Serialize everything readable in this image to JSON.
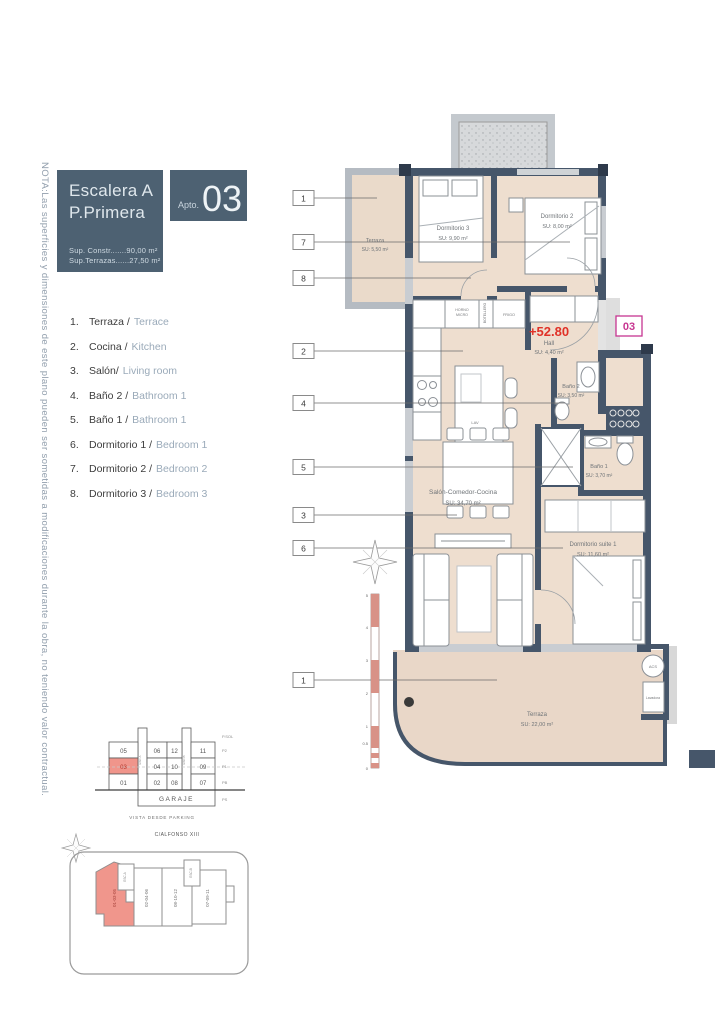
{
  "note": "NOTA:Las superficies y dimensiones de este plano pueden ser sometidas a modificaciones durante la obra, no teniendo valor contractual.",
  "header": {
    "escalera": "Escalera A",
    "planta": "P.Primera",
    "apto_label": "Apto.",
    "apto_num": "03",
    "sup_constr": "Sup. Constr.......90,00 m²",
    "sup_terrazas": "Sup.Terrazas......27,50 m²"
  },
  "legend": {
    "items": [
      {
        "num": "1.",
        "es": "Terraza /",
        "en": "Terrace"
      },
      {
        "num": "2.",
        "es": "Cocina /",
        "en": "Kitchen"
      },
      {
        "num": "3.",
        "es": "Salón/",
        "en": "Living room"
      },
      {
        "num": "4.",
        "es": "Baño 2 /",
        "en": "Bathroom 1"
      },
      {
        "num": "5.",
        "es": "Baño 1 /",
        "en": "Bathroom 1"
      },
      {
        "num": "6.",
        "es": "Dormitorio 1 /",
        "en": "Bedroom 1"
      },
      {
        "num": "7.",
        "es": "Dormitorio 2 /",
        "en": "Bedroom 2"
      },
      {
        "num": "8.",
        "es": "Dormitorio 3 /",
        "en": "Bedroom 3"
      }
    ]
  },
  "plan": {
    "level_mark": "+52.80",
    "unit_badge": "03",
    "callouts": [
      "1",
      "7",
      "8",
      "2",
      "4",
      "5",
      "3",
      "6",
      "1"
    ],
    "scale": [
      "5",
      "4",
      "3",
      "2",
      "1",
      "0.5",
      "0"
    ],
    "rooms": {
      "terraza_top": {
        "name": "Terraza",
        "su": "SU: 5,50 m²"
      },
      "dormitorio3": {
        "name": "Dormitorio 3",
        "su": "SU: 9,90 m²"
      },
      "dormitorio2": {
        "name": "Dormitorio 2",
        "su": "SU: 8,00 m²"
      },
      "hall": {
        "name": "Hall",
        "su": "SU: 4,40 m²"
      },
      "bano2": {
        "name": "Baño 2",
        "su": "SU: 3,50 m²"
      },
      "bano1": {
        "name": "Baño 1",
        "su": "SU: 3,70 m²"
      },
      "salon": {
        "name": "Salón-Comedor-Cocina",
        "su": "SU: 34,70 m²"
      },
      "suite": {
        "name": "Dormitorio suite 1",
        "su": "SU: 11,60 m²"
      },
      "terraza_bottom": {
        "name": "Terraza",
        "su": "SU: 22,00 m²"
      }
    },
    "kitchen": {
      "horno1": "HORNO",
      "horno2": "MICRO",
      "botellero": "BOTELLERO",
      "frigo": "FRIGO",
      "lav": "LAV"
    },
    "utility": {
      "acs": "ACS",
      "lavadora": "Lavadora"
    }
  },
  "stack": {
    "rows": [
      [
        "05",
        "06",
        "12",
        "11"
      ],
      [
        "03",
        "04",
        "10",
        "09"
      ],
      [
        "01",
        "02",
        "08",
        "07"
      ]
    ],
    "garage": "GARAJE",
    "levels": [
      "P.SOL",
      "P2",
      "P1",
      "PB",
      "PS"
    ],
    "esc_a": "ESC.A",
    "esc_b": "ESC.B",
    "caption": "VISTA DESDE PARKING"
  },
  "site": {
    "street": "C/ALFONSO XIII",
    "blocks": [
      "01-03-05",
      "02-04-06",
      "08-10-12",
      "07-09-11"
    ],
    "esc_a": "ESC.A",
    "esc_b": "ESC.B"
  },
  "colors": {
    "wall": "#46566a",
    "room_fill": "#eedecf",
    "terrace_fill": "#e9d7c8",
    "header_bg": "#4d6172",
    "highlight": "#f0958b",
    "level_red": "#e03127",
    "unit_magenta": "#c73691",
    "window": "#c9cdd2",
    "english_text": "#9aaab9"
  }
}
